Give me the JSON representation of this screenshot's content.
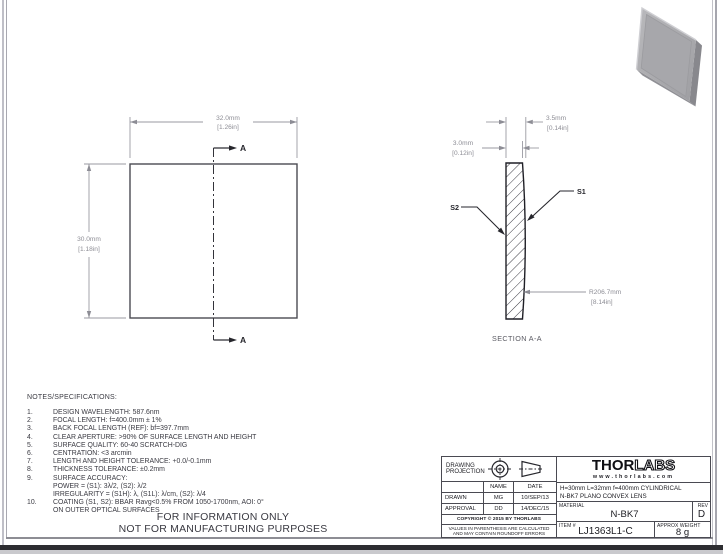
{
  "drawing": {
    "front_view": {
      "width_mm": "32.0mm",
      "width_in": "[1.26in]",
      "height_mm": "30.0mm",
      "height_in": "[1.18in]",
      "section_letter_top": "A",
      "section_letter_bottom": "A"
    },
    "section_view": {
      "thickness_mm": "3.5mm",
      "thickness_in": "[0.14in]",
      "edge_mm": "3.0mm",
      "edge_in": "[0.12in]",
      "radius_mm": "R206.7mm",
      "radius_in": "[8.14in]",
      "surface1": "S1",
      "surface2": "S2",
      "caption": "SECTION A-A"
    }
  },
  "notes": {
    "heading": "NOTES/SPECIFICATIONS:",
    "items": [
      {
        "num": "1.",
        "text": "DESIGN WAVELENGTH: 587.6nm"
      },
      {
        "num": "2.",
        "text": "FOCAL LENGTH: f=400.0mm ± 1%"
      },
      {
        "num": "3.",
        "text": "BACK FOCAL LENGTH (REF):  bf=397.7mm"
      },
      {
        "num": "4.",
        "text": "CLEAR APERTURE: >90% OF SURFACE LENGTH AND HEIGHT"
      },
      {
        "num": "5.",
        "text": "SURFACE QUALITY: 60-40 SCRATCH-DIG"
      },
      {
        "num": "6.",
        "text": "CENTRATION: <3 arcmin"
      },
      {
        "num": "7.",
        "text": "LENGTH AND HEIGHT TOLERANCE: +0.0/-0.1mm"
      },
      {
        "num": "8.",
        "text": "THICKNESS TOLERANCE: ±0.2mm"
      },
      {
        "num": "9.",
        "text": "SURFACE ACCURACY:"
      },
      {
        "num": "",
        "text": "POWER = (S1): 3λ/2, (S2): λ/2"
      },
      {
        "num": "",
        "text": "IRREGULARITY = (S1H): λ, (S1L): λ/cm, (S2): λ/4"
      },
      {
        "num": "10.",
        "text": "COATING (S1, S2): BBAR Ravg<0.5% FROM 1050-1700nm, AOI: 0°"
      },
      {
        "num": "",
        "text": "ON OUTER OPTICAL SURFACES"
      }
    ],
    "footer_line1": "FOR INFORMATION ONLY",
    "footer_line2": "NOT FOR MANUFACTURING PURPOSES"
  },
  "title_block": {
    "projection_label": "DRAWING PROJECTION",
    "col_name": "NAME",
    "col_date": "DATE",
    "drawn_label": "DRAWN",
    "drawn_name": "MG",
    "drawn_date": "10/SEP/13",
    "approval_label": "APPROVAL",
    "approval_name": "DD",
    "approval_date": "14/DEC/15",
    "copyright": "COPYRIGHT © 2015 BY THORLABS",
    "disclaimer_line1": "VALUES IN PARENTHESIS ARE CALCULATED",
    "disclaimer_line2": "AND MAY CONTAIN ROUNDOFF ERRORS",
    "logo_thor": "THOR",
    "logo_labs": "LABS",
    "website": "www.thorlabs.com",
    "description_line1": "H=30mm L=32mm f=400mm CYLINDRICAL",
    "description_line2": "N-BK7 PLANO CONVEX LENS",
    "material_label": "MATERIAL",
    "material_value": "N-BK7",
    "rev_label": "REV",
    "rev_value": "D",
    "item_label": "ITEM #",
    "item_value": "LJ1363L1-C",
    "weight_label": "APPROX WEIGHT",
    "weight_value": "8 g"
  },
  "colors": {
    "outline": "#2b2b31",
    "dimension": "#8d8d95",
    "band": "#2d2d31",
    "render_gray": "#a6a6aa"
  }
}
